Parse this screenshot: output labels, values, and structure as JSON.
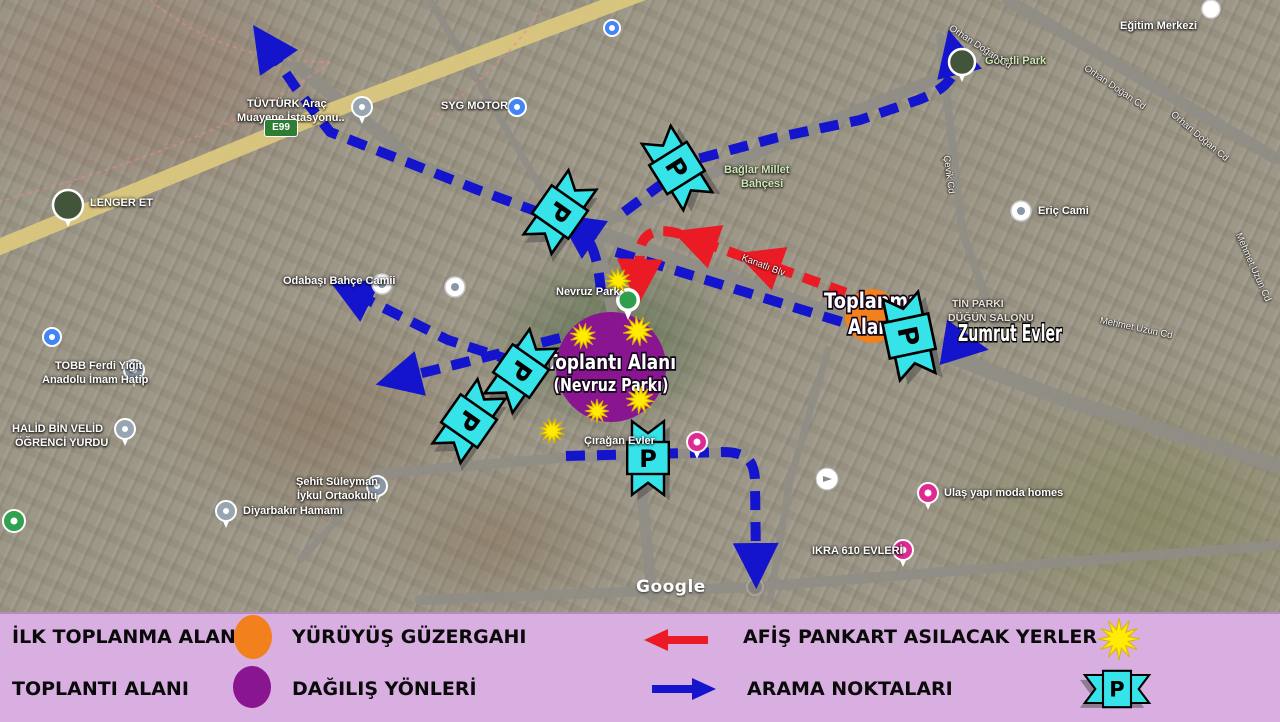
{
  "colors": {
    "blue": "#1414cc",
    "red": "#ea1b24",
    "cyan": "#35e3e8",
    "orange": "#f2801d",
    "purple": "#8a1591",
    "yellow": "#ffec00",
    "legend_bg": "#d9afe2",
    "road": "#8f8d85",
    "highway": "#dcc97e"
  },
  "map": {
    "watermark": "Google",
    "highway_badge": "E99",
    "p_letter": "P",
    "areas": {
      "purple": {
        "cx": 611,
        "cy": 367,
        "r": 55,
        "line1": "Toplantı Alanı",
        "line2": "(Nevruz Parkı)",
        "len1": 130,
        "len2": 115
      },
      "orange": {
        "cx": 872,
        "cy": 316,
        "r": 27,
        "line1": "Toplanma",
        "line2": "Alanı",
        "len1": 96,
        "len2": 48
      },
      "zumrut": {
        "x": 958,
        "y": 341,
        "text": "Zumrut Evler",
        "len": 104
      }
    },
    "roads": [
      {
        "d": "M 585 228 L 760 290 L 908 340 L 1060 398 L 1275 465",
        "w": 15
      },
      {
        "d": "M 585 228 L 420 166 L 255 32",
        "w": 13
      },
      {
        "d": "M 608 220 L 790 138 L 958 70",
        "w": 12
      },
      {
        "d": "M 597 236 L 618 340 L 638 452 L 652 596",
        "w": 11
      },
      {
        "d": "M 378 474 L 560 458 L 744 452",
        "w": 10
      },
      {
        "d": "M 1008 0 L 1275 158",
        "w": 12
      },
      {
        "d": "M 940 36 L 962 230 L 1000 338",
        "w": 8
      },
      {
        "d": "M 430 0 L 560 220",
        "w": 7
      },
      {
        "d": "M 828 350 L 790 480 L 770 600",
        "w": 7
      },
      {
        "d": "M 380 474 L 300 560",
        "w": 7
      },
      {
        "d": "M 420 600 L 755 587 L 1280 545",
        "w": 10
      },
      {
        "d": "M -8 250 L 320 115 L 655 -12",
        "w": 16,
        "c": "#dcc97e"
      }
    ],
    "roundabouts": [
      [
        585,
        228,
        8
      ],
      [
        755,
        587,
        8
      ]
    ],
    "pink_paths": [
      "M 5 200 C 120 168 240 130 330 62",
      "M 150 0 C 205 45 265 62 330 62",
      "M 430 120 C 470 92 520 45 545 5"
    ],
    "blue_routes": [
      "M 598 234 L 478 190 L 330 132 L 296 88 L 266 44",
      "M 624 212 L 694 160 L 775 138 L 860 120 L 918 100 C 945 90 960 76 954 52",
      "M 616 252 L 700 278 L 790 306 L 868 330 L 966 346",
      "M 560 338 L 470 361 L 398 379",
      "M 516 362 L 448 340 L 350 291",
      "M 566 456 L 648 454 L 722 452 C 748 452 754 462 755 480 L 756 566",
      "M 601 292 C 598 258 592 238 576 227"
    ],
    "red_routes": [
      "M 872 302 L 758 261",
      "M 744 257 L 694 239",
      "M 680 234 C 656 227 642 233 640 251 L 639 282"
    ],
    "stars": [
      [
        618,
        281,
        13,
        0
      ],
      [
        583,
        336,
        13,
        12
      ],
      [
        638,
        331,
        15,
        22
      ],
      [
        640,
        400,
        14,
        6
      ],
      [
        597,
        411,
        12,
        0
      ],
      [
        552,
        431,
        13,
        16
      ]
    ],
    "p_banners": [
      [
        560,
        212,
        35,
        90,
        0.85
      ],
      [
        677,
        168,
        -32,
        90,
        0.85
      ],
      [
        521,
        371,
        35,
        90,
        0.85
      ],
      [
        469,
        421,
        35,
        90,
        0.85
      ],
      [
        648,
        458,
        0,
        0,
        0.8
      ],
      [
        909,
        336,
        -12,
        90,
        0.9
      ]
    ],
    "pois": [
      {
        "text": "LENGER ET",
        "tx": 90,
        "ty": 197,
        "cls": "poi",
        "icon": "photo",
        "ix": 68,
        "iy": 205,
        "ir": 15
      },
      {
        "text": "TÜVTÜRK Araç",
        "tx": 247,
        "ty": 98,
        "cls": "poi"
      },
      {
        "text": "Muayene İstasyonu..",
        "tx": 237,
        "ty": 112,
        "cls": "poi",
        "icon": "gray",
        "ix": 362,
        "iy": 107,
        "ir": 10
      },
      {
        "text": "SYG MOTOR",
        "tx": 441,
        "ty": 100,
        "cls": "poi",
        "icon": "blue",
        "ix": 517,
        "iy": 107,
        "ir": 9
      },
      {
        "text": "",
        "icon": "blue",
        "ix": 612,
        "iy": 28,
        "ir": 8
      },
      {
        "text": "",
        "icon": "blue",
        "ix": 52,
        "iy": 337,
        "ir": 9
      },
      {
        "text": "Göletli Park",
        "tx": 985,
        "ty": 55,
        "cls": "park",
        "icon": "photo",
        "ix": 962,
        "iy": 62,
        "ir": 13
      },
      {
        "text": "Eğitim Merkezi",
        "tx": 1120,
        "ty": 20,
        "cls": "poi",
        "icon": "white",
        "ix": 1211,
        "iy": 9,
        "ir": 9
      },
      {
        "text": "Bağlar Millet",
        "tx": 724,
        "ty": 164,
        "cls": "park"
      },
      {
        "text": "Bahçesi",
        "tx": 741,
        "ty": 178,
        "cls": "park"
      },
      {
        "text": "Eriç Cami",
        "tx": 1038,
        "ty": 205,
        "cls": "poi",
        "icon": "mosque",
        "ix": 1021,
        "iy": 211,
        "ir": 10
      },
      {
        "text": "Odabaşı Bahçe Camii",
        "tx": 283,
        "ty": 275,
        "cls": "poi",
        "icon": "govt",
        "ix": 382,
        "iy": 284,
        "ir": 10
      },
      {
        "text": "",
        "icon": "mosque",
        "ix": 455,
        "iy": 287,
        "ir": 10
      },
      {
        "text": "TOBB Ferdi Yiğit",
        "tx": 55,
        "ty": 360,
        "cls": "poi"
      },
      {
        "text": "Anadolu İmam Hatip",
        "tx": 42,
        "ty": 374,
        "cls": "poi",
        "icon": "school",
        "ix": 134,
        "iy": 370,
        "ir": 10
      },
      {
        "text": "HALİD BİN VELİD",
        "tx": 12,
        "ty": 423,
        "cls": "poi"
      },
      {
        "text": "ÖĞRENCİ YURDU",
        "tx": 15,
        "ty": 437,
        "cls": "poi",
        "icon": "gray",
        "ix": 125,
        "iy": 429,
        "ir": 10
      },
      {
        "text": "Şehit Süleyman",
        "tx": 296,
        "ty": 476,
        "cls": "poi"
      },
      {
        "text": "İykul Ortaokulu",
        "tx": 297,
        "ty": 490,
        "cls": "poi",
        "icon": "school",
        "ix": 377,
        "iy": 486,
        "ir": 10
      },
      {
        "text": "Diyarbakır Hamamı",
        "tx": 243,
        "ty": 505,
        "cls": "poi",
        "icon": "gray",
        "ix": 226,
        "iy": 511,
        "ir": 10
      },
      {
        "text": "Çırağan Evler",
        "tx": 584,
        "ty": 435,
        "cls": "poi",
        "icon": "pink",
        "ix": 697,
        "iy": 442,
        "ir": 10
      },
      {
        "text": "Ulaş yapı moda homes",
        "tx": 944,
        "ty": 487,
        "cls": "poi",
        "icon": "pink",
        "ix": 928,
        "iy": 493,
        "ir": 10
      },
      {
        "text": "IKRA 610 EVLERİ",
        "tx": 812,
        "ty": 545,
        "cls": "poi",
        "icon": "pink",
        "ix": 903,
        "iy": 550,
        "ir": 10
      },
      {
        "text": "TİN PARKI",
        "tx": 952,
        "ty": 298,
        "cls": "dim"
      },
      {
        "text": "DÜĞÜN SALONU",
        "tx": 948,
        "ty": 312,
        "cls": "dim"
      },
      {
        "text": "Nevruz Park",
        "tx": 556,
        "ty": 286,
        "cls": "poi"
      },
      {
        "text": "",
        "icon": "sv",
        "ix": 827,
        "iy": 479,
        "ir": 11
      },
      {
        "text": "",
        "icon": "greenround",
        "ix": 14,
        "iy": 521,
        "ir": 11
      },
      {
        "text": "",
        "icon": "pin-green",
        "ix": 628,
        "iy": 300,
        "ir": 12
      }
    ],
    "streets": [
      {
        "text": "Orhan Doğan Cd",
        "x": 950,
        "y": 22,
        "rot": 33
      },
      {
        "text": "Orhan Doğan Cd",
        "x": 1085,
        "y": 62,
        "rot": 34
      },
      {
        "text": "Orhan Doğan Cd",
        "x": 1172,
        "y": 108,
        "rot": 40
      },
      {
        "text": "Çevik Cd",
        "x": 946,
        "y": 150,
        "rot": 82
      },
      {
        "text": "Mehmet Uzun Cd",
        "x": 1100,
        "y": 315,
        "rot": 12
      },
      {
        "text": "Mehmet Uzun Cd",
        "x": 1238,
        "y": 228,
        "rot": 66
      },
      {
        "text": "Kanatlı Blv",
        "x": 742,
        "y": 252,
        "rot": 21
      }
    ]
  },
  "legend": {
    "row1": {
      "label1": "İLK TOPLANMA ALANI",
      "icon1": "orange-circle",
      "label2": "YÜRÜYÜŞ GÜZERGAHI",
      "icon2": "red-arrow-left",
      "label3": "AFİŞ PANKART ASILACAK YERLER",
      "icon3": "yellow-star"
    },
    "row2": {
      "label1": "TOPLANTI ALANI",
      "icon1": "purple-circle",
      "label2": "DAĞILIŞ YÖNLERİ",
      "icon2": "blue-arrow-right",
      "label3": "ARAMA NOKTALARI",
      "icon3": "cyan-p-banner"
    }
  }
}
